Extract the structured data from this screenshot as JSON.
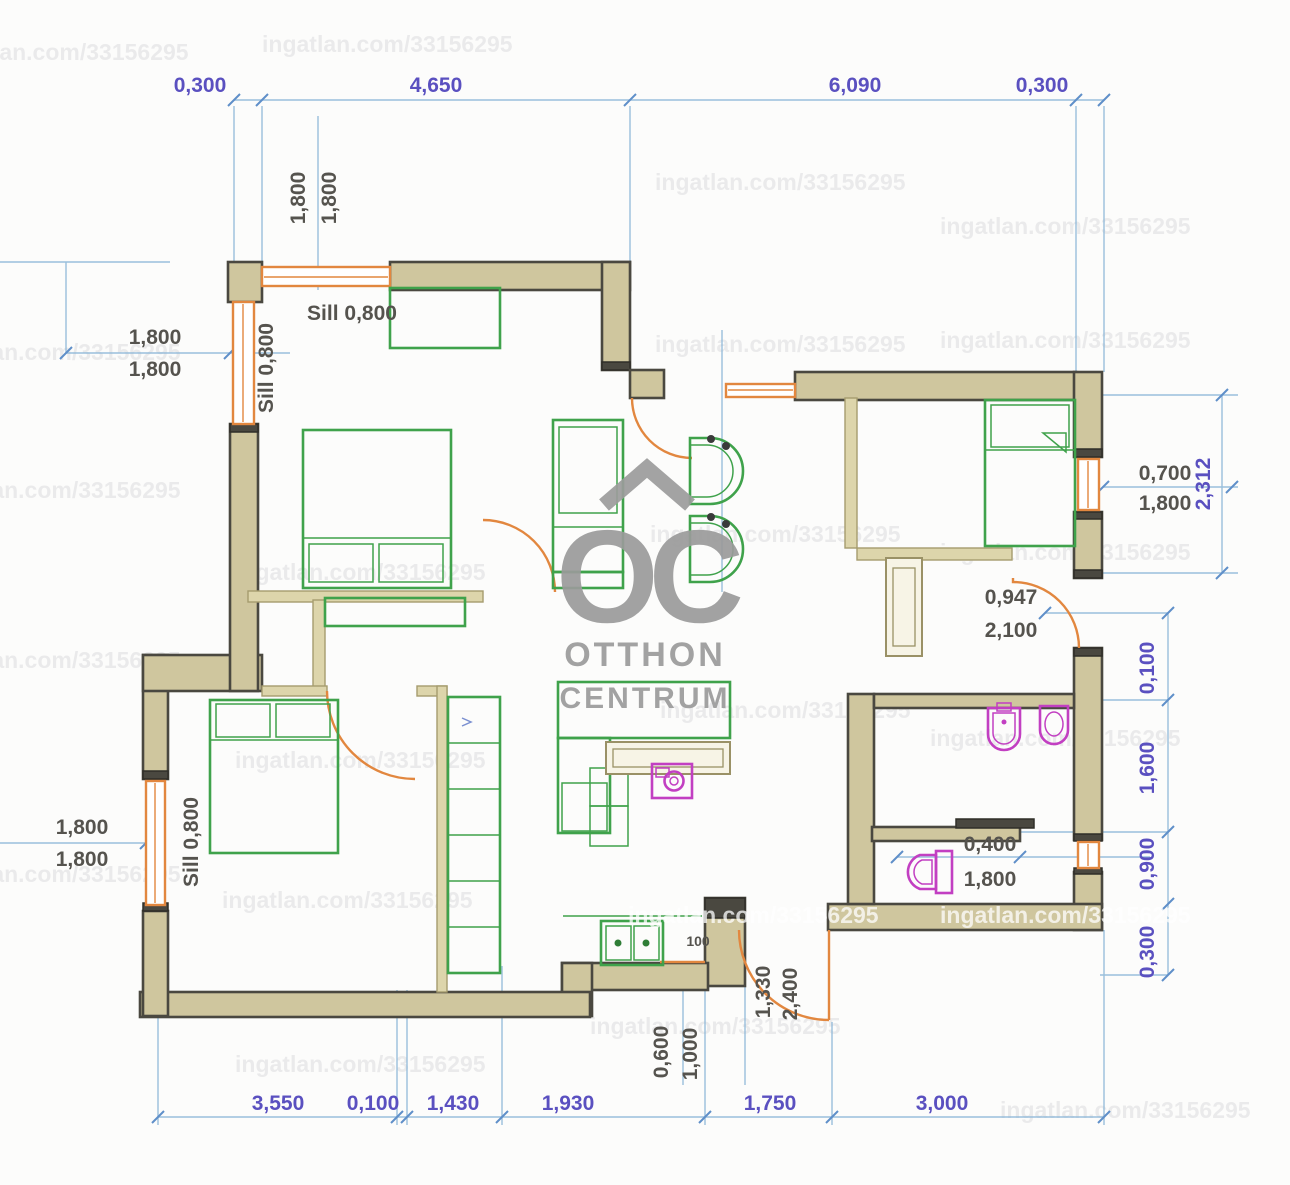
{
  "watermark": {
    "text": "ingatlan.com/33156295"
  },
  "logo": {
    "initials": "OC",
    "line1": "OTTHON",
    "line2": "CENTRUM"
  },
  "labels": {
    "sill_top_h": "Sill 0,800",
    "sill_top_v": "Sill 0,800",
    "sill_low_v": "Sill 0,800",
    "entry_post": "100"
  },
  "dims": {
    "top": [
      "0,300",
      "4,650",
      "6,090",
      "0,300"
    ],
    "left_top_v": [
      "1,800",
      "1,800"
    ],
    "left_mid": [
      "1,800",
      "1,800"
    ],
    "left_low": [
      "1,800",
      "1,800"
    ],
    "right_window": [
      "0,700",
      "1,800"
    ],
    "right_span": "2,312",
    "right_door": [
      "0,947",
      "2,100"
    ],
    "right_chain": [
      "0,100",
      "1,600",
      "0,900",
      "0,300"
    ],
    "wc": [
      "0,400",
      "1,800"
    ],
    "bottom": [
      "3,550",
      "0,100",
      "1,430",
      "1,930",
      "1,750",
      "3,000"
    ],
    "entry_v": [
      "0,600",
      "1,000",
      "1,330",
      "2,400"
    ]
  },
  "colors": {
    "wall": "#cfc69e",
    "wall_dark": "#4a4840",
    "partition": "#ddd5ab",
    "window": "#e2873f",
    "furniture": "#3fa24b",
    "fixture": "#c23fc2",
    "dim_line": "#8fb8d8",
    "dim_text": "#5a50c0",
    "dim_text_gray": "#55534e",
    "logo": "#9b9b9b",
    "watermark": "#8a8a95"
  }
}
